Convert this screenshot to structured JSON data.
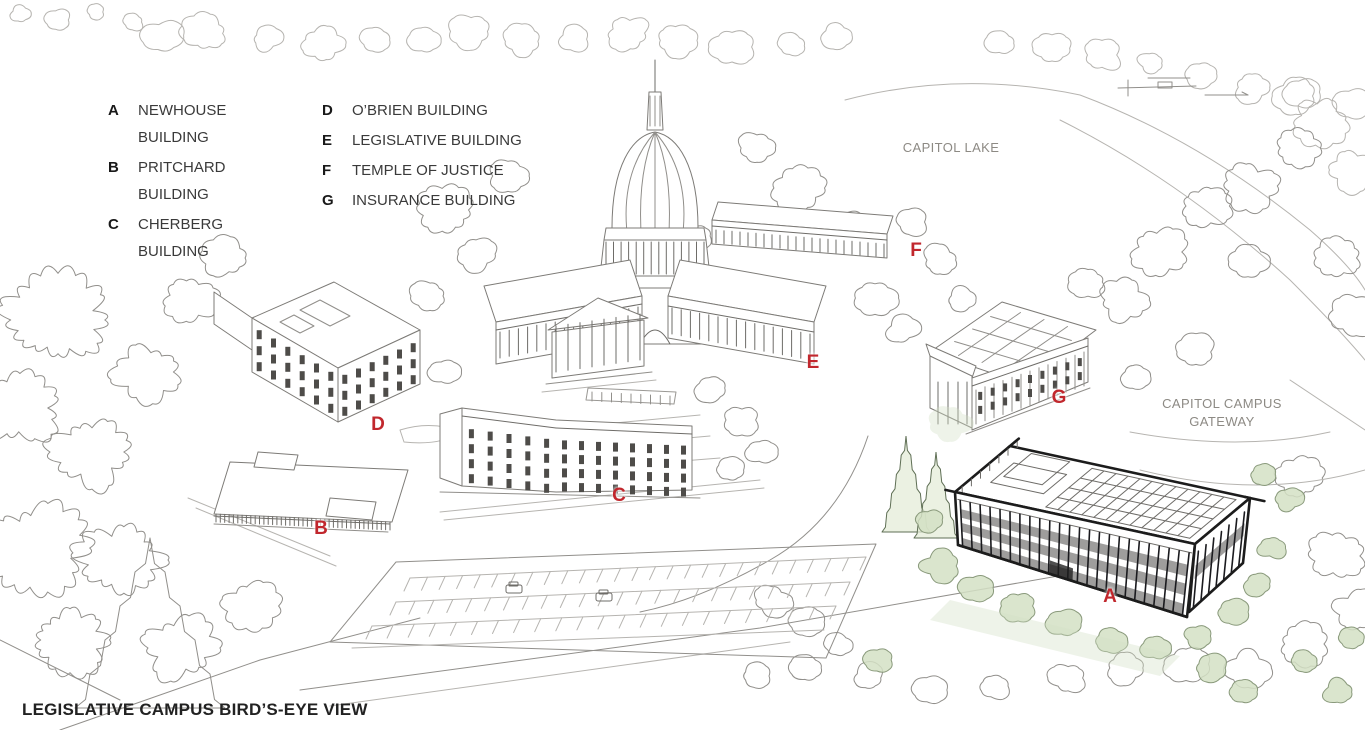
{
  "legend": {
    "columns": [
      [
        {
          "letter": "A",
          "name": "NEWHOUSE BUILDING"
        },
        {
          "letter": "B",
          "name": "PRITCHARD BUILDING"
        },
        {
          "letter": "C",
          "name": "CHERBERG BUILDING"
        }
      ],
      [
        {
          "letter": "D",
          "name": "O’BRIEN BUILDING"
        },
        {
          "letter": "E",
          "name": "LEGISLATIVE BUILDING"
        },
        {
          "letter": "F",
          "name": "TEMPLE OF JUSTICE"
        },
        {
          "letter": "G",
          "name": "INSURANCE BUILDING"
        }
      ]
    ]
  },
  "map_labels": {
    "capitol_lake": "CAPITOL LAKE",
    "capitol_campus_gateway": "CAPITOL CAMPUS\nGATEWAY"
  },
  "map_markers": [
    {
      "letter": "A",
      "building": "Newhouse Building",
      "x": 1110,
      "y": 598
    },
    {
      "letter": "B",
      "building": "Pritchard Building",
      "x": 321,
      "y": 530
    },
    {
      "letter": "C",
      "building": "Cherberg Building",
      "x": 619,
      "y": 497
    },
    {
      "letter": "D",
      "building": "O’Brien Building",
      "x": 378,
      "y": 426
    },
    {
      "letter": "E",
      "building": "Legislative Building",
      "x": 813,
      "y": 364
    },
    {
      "letter": "F",
      "building": "Temple of Justice",
      "x": 916,
      "y": 252
    },
    {
      "letter": "G",
      "building": "Insurance Building",
      "x": 1059,
      "y": 399
    }
  ],
  "caption": "LEGISLATIVE CAMPUS BIRD’S-EYE VIEW",
  "colors": {
    "marker": "#c1272d",
    "foliage": "#d3e0c4",
    "ink_light": "#918f8b",
    "ink_bold": "#1c1c1c",
    "legend_text": "#3a3a3a",
    "label_text": "#8d8a84"
  }
}
